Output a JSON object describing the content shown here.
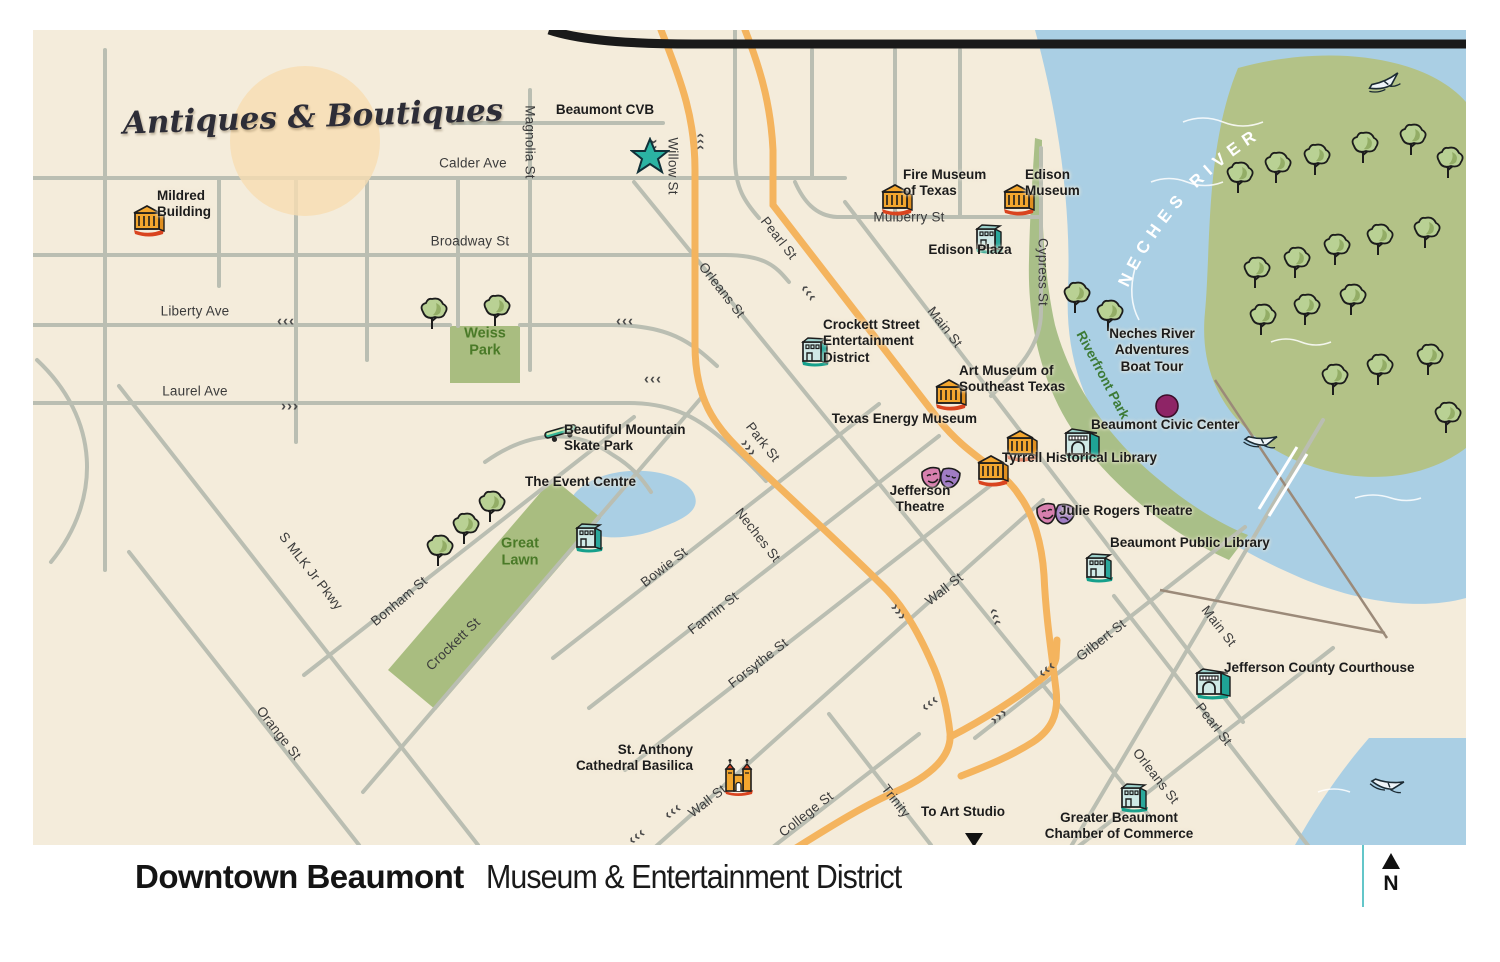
{
  "title": {
    "primary": "Downtown Beaumont",
    "secondary": "Museum & Entertainment District"
  },
  "north_label": "N",
  "decor": {
    "antiques_label": "Antiques & Boutiques",
    "river_label": "NECHES RIVER",
    "riverfront_label": "Riverfront Park"
  },
  "shields": {
    "interstate": "10",
    "us_route": "90"
  },
  "park_labels": [
    {
      "id": "weiss-park",
      "lines": [
        "Weiss",
        "Park"
      ],
      "x": 452,
      "y": 312
    },
    {
      "id": "great-lawn",
      "lines": [
        "Great",
        "Lawn"
      ],
      "x": 487,
      "y": 522
    }
  ],
  "street_labels": [
    {
      "text": "Magnolia St",
      "x": 497,
      "y": 112,
      "rot": 90
    },
    {
      "text": "Willow St",
      "x": 640,
      "y": 136,
      "rot": 90
    },
    {
      "text": "Calder Ave",
      "x": 440,
      "y": 133,
      "rot": 0
    },
    {
      "text": "Broadway St",
      "x": 437,
      "y": 211,
      "rot": 0
    },
    {
      "text": "Liberty Ave",
      "x": 162,
      "y": 281,
      "rot": 0
    },
    {
      "text": "Laurel Ave",
      "x": 162,
      "y": 361,
      "rot": 0
    },
    {
      "text": "Mulberry St",
      "x": 876,
      "y": 187,
      "rot": 0
    },
    {
      "text": "Cypress St",
      "x": 1010,
      "y": 242,
      "rot": 90
    },
    {
      "text": "Pearl St",
      "x": 746,
      "y": 208,
      "rot": 52
    },
    {
      "text": "Orleans St",
      "x": 689,
      "y": 260,
      "rot": 52
    },
    {
      "text": "Main St",
      "x": 912,
      "y": 297,
      "rot": 52
    },
    {
      "text": "Park St",
      "x": 730,
      "y": 412,
      "rot": 52
    },
    {
      "text": "Neches St",
      "x": 725,
      "y": 505,
      "rot": 52
    },
    {
      "text": "Bowie St",
      "x": 631,
      "y": 537,
      "rot": -38
    },
    {
      "text": "Fannin St",
      "x": 680,
      "y": 583,
      "rot": -38
    },
    {
      "text": "Forsythe St",
      "x": 725,
      "y": 633,
      "rot": -38
    },
    {
      "text": "Wall St",
      "x": 911,
      "y": 559,
      "rot": -38
    },
    {
      "text": "Wall St",
      "x": 674,
      "y": 771,
      "rot": -38
    },
    {
      "text": "Crockett St",
      "x": 420,
      "y": 614,
      "rot": -44
    },
    {
      "text": "Bonham St",
      "x": 366,
      "y": 571,
      "rot": -40
    },
    {
      "text": "S MLK Jr Pkwy",
      "x": 278,
      "y": 541,
      "rot": 52
    },
    {
      "text": "Orange St",
      "x": 246,
      "y": 703,
      "rot": 52
    },
    {
      "text": "College St",
      "x": 773,
      "y": 784,
      "rot": -38
    },
    {
      "text": "Trinity",
      "x": 863,
      "y": 771,
      "rot": 52
    },
    {
      "text": "Gilbert  St",
      "x": 1068,
      "y": 610,
      "rot": -38
    },
    {
      "text": "Main St",
      "x": 1186,
      "y": 596,
      "rot": 52
    },
    {
      "text": "Pearl St",
      "x": 1181,
      "y": 694,
      "rot": 52
    },
    {
      "text": "Orleans St",
      "x": 1123,
      "y": 746,
      "rot": 52
    }
  ],
  "arrows": [
    {
      "g": "‹‹‹",
      "x": 253,
      "y": 291,
      "rot": 0
    },
    {
      "g": "‹‹‹",
      "x": 592,
      "y": 291,
      "rot": 0
    },
    {
      "g": "›››",
      "x": 257,
      "y": 376,
      "rot": 0
    },
    {
      "g": "‹‹‹",
      "x": 620,
      "y": 349,
      "rot": 0
    },
    {
      "g": "›››",
      "x": 621,
      "y": 118,
      "rot": 90
    },
    {
      "g": "‹‹‹",
      "x": 668,
      "y": 112,
      "rot": 90
    },
    {
      "g": "‹‹‹",
      "x": 776,
      "y": 263,
      "rot": 52
    },
    {
      "g": "›››",
      "x": 716,
      "y": 418,
      "rot": 52
    },
    {
      "g": "›››",
      "x": 866,
      "y": 582,
      "rot": 52
    },
    {
      "g": "‹‹‹",
      "x": 963,
      "y": 587,
      "rot": 72
    },
    {
      "g": "‹‹‹",
      "x": 640,
      "y": 781,
      "rot": -38
    },
    {
      "g": "‹‹‹",
      "x": 604,
      "y": 806,
      "rot": -38
    },
    {
      "g": "‹‹‹",
      "x": 897,
      "y": 673,
      "rot": -38
    },
    {
      "g": "›››",
      "x": 966,
      "y": 686,
      "rot": -38
    },
    {
      "g": "‹‹‹",
      "x": 1014,
      "y": 639,
      "rot": -38
    }
  ],
  "pois": [
    {
      "id": "mildred-building",
      "icon": "museum",
      "icon_x": 97,
      "icon_y": 173,
      "label_lines": [
        "Mildred",
        "Building"
      ],
      "label_x": 124,
      "label_y": 158,
      "anchor": "left"
    },
    {
      "id": "beaumont-cvb",
      "icon": "star",
      "icon_x": 597,
      "icon_y": 107,
      "label_lines": [
        "Beaumont CVB"
      ],
      "label_x": 572,
      "label_y": 72,
      "anchor": "center"
    },
    {
      "id": "fire-museum-of-texas",
      "icon": "museum",
      "icon_x": 845,
      "icon_y": 152,
      "label_lines": [
        "Fire Museum",
        "of Texas"
      ],
      "label_x": 870,
      "label_y": 137,
      "anchor": "left"
    },
    {
      "id": "edison-museum",
      "icon": "museum",
      "icon_x": 967,
      "icon_y": 152,
      "label_lines": [
        "Edison",
        "Museum"
      ],
      "label_x": 992,
      "label_y": 137,
      "anchor": "left"
    },
    {
      "id": "edison-plaza",
      "icon": "bldg",
      "icon_x": 939,
      "icon_y": 190,
      "label_lines": [
        "Edison Plaza"
      ],
      "label_x": 937,
      "label_y": 212,
      "anchor": "center"
    },
    {
      "id": "crockett-street-entertainment-district",
      "icon": "bldg",
      "icon_x": 765,
      "icon_y": 303,
      "label_lines": [
        "Crockett Street",
        "Entertainment",
        "District"
      ],
      "label_x": 790,
      "label_y": 287,
      "anchor": "left"
    },
    {
      "id": "art-museum-of-southeast-texas",
      "icon": "museum",
      "icon_x": 899,
      "icon_y": 347,
      "label_lines": [
        "Art Museum of",
        "Southeast Texas"
      ],
      "label_x": 926,
      "label_y": 333,
      "anchor": "left"
    },
    {
      "id": "texas-energy-museum",
      "icon": "museum",
      "icon_x": 970,
      "icon_y": 398,
      "label_lines": [
        "Texas Energy Museum"
      ],
      "label_x": 944,
      "label_y": 381,
      "anchor": "right"
    },
    {
      "id": "beaumont-civic-center",
      "icon": "arch",
      "icon_x": 1029,
      "icon_y": 394,
      "label_lines": [
        "Beaumont Civic Center"
      ],
      "label_x": 1058,
      "label_y": 387,
      "anchor": "left"
    },
    {
      "id": "tyrrell-historical-library",
      "icon": "museum",
      "icon_x": 941,
      "icon_y": 423,
      "label_lines": [
        "Tyrrell Historical Library"
      ],
      "label_x": 969,
      "label_y": 420,
      "anchor": "left"
    },
    {
      "id": "jefferson-theatre",
      "icon": "masks",
      "icon_x": 887,
      "icon_y": 434,
      "label_lines": [
        "Jefferson",
        "Theatre"
      ],
      "label_x": 887,
      "label_y": 453,
      "anchor": "center"
    },
    {
      "id": "julie-rogers-theatre",
      "icon": "masks",
      "icon_x": 1002,
      "icon_y": 470,
      "label_lines": [
        "Julie Rogers Theatre"
      ],
      "label_x": 1026,
      "label_y": 473,
      "anchor": "left"
    },
    {
      "id": "beaumont-public-library",
      "icon": "bldg",
      "icon_x": 1049,
      "icon_y": 519,
      "label_lines": [
        "Beaumont Public Library"
      ],
      "label_x": 1077,
      "label_y": 505,
      "anchor": "left"
    },
    {
      "id": "neches-river-adventures-boat-tour",
      "icon": "dot",
      "icon_x": 1120,
      "icon_y": 362,
      "label_lines": [
        "Neches River",
        "Adventures",
        "Boat Tour"
      ],
      "label_x": 1119,
      "label_y": 296,
      "anchor": "center"
    },
    {
      "id": "beautiful-mountain-skate-park",
      "icon": "skate",
      "icon_x": 509,
      "icon_y": 390,
      "label_lines": [
        "Beautiful Mountain",
        "Skate Park"
      ],
      "label_x": 531,
      "label_y": 392,
      "anchor": "left"
    },
    {
      "id": "the-event-centre",
      "icon": "bldg",
      "icon_x": 539,
      "icon_y": 489,
      "label_lines": [
        "The Event Centre"
      ],
      "label_x": 492,
      "label_y": 444,
      "anchor": "left"
    },
    {
      "id": "st-anthony-cathedral-basilica",
      "icon": "church",
      "icon_x": 686,
      "icon_y": 727,
      "label_lines": [
        "St. Anthony",
        "Cathedral Basilica"
      ],
      "label_x": 660,
      "label_y": 712,
      "anchor": "right"
    },
    {
      "id": "jefferson-county-courthouse",
      "icon": "arch",
      "icon_x": 1160,
      "icon_y": 634,
      "label_lines": [
        "Jefferson County Courthouse"
      ],
      "label_x": 1191,
      "label_y": 630,
      "anchor": "left"
    },
    {
      "id": "greater-beaumont-chamber-of-commerce",
      "icon": "bldg",
      "icon_x": 1084,
      "icon_y": 749,
      "label_lines": [
        "Greater Beaumont",
        "Chamber of Commerce"
      ],
      "label_x": 1086,
      "label_y": 780,
      "anchor": "center"
    },
    {
      "id": "to-art-studio",
      "icon": "tri",
      "icon_x": 930,
      "icon_y": 801,
      "label_lines": [
        "To Art Studio"
      ],
      "label_x": 930,
      "label_y": 774,
      "anchor": "center"
    }
  ]
}
